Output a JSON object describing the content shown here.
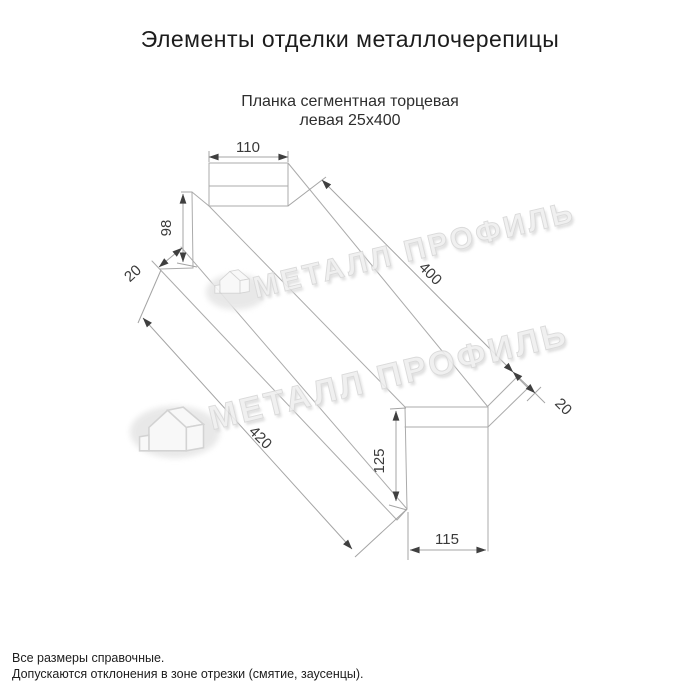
{
  "page": {
    "title": "Элементы отделки металлочерепицы",
    "subtitle1": "Планка сегментная торцевая",
    "subtitle2": "левая 25х400"
  },
  "drawing": {
    "product": "Планка сегментная торцевая левая 25х400",
    "dims": {
      "top_width": "110",
      "left_height": "98",
      "left_hem": "20",
      "upper_length": "400",
      "right_hem": "20",
      "lower_length": "420",
      "right_height": "125",
      "bottom_width": "115"
    },
    "watermark": {
      "text": "МЕТАЛЛ ПРОФИЛЬ"
    }
  },
  "footer": {
    "note1": "Все размеры справочные.",
    "note2": "Допускаются отклонения в зоне отрезки (смятие, заусенцы)."
  },
  "colors": {
    "background": "#ffffff",
    "line": "#ababab",
    "dim_text": "#3a3a3a",
    "title_text": "#1c1c1c",
    "watermark": "#e0e0e0"
  }
}
